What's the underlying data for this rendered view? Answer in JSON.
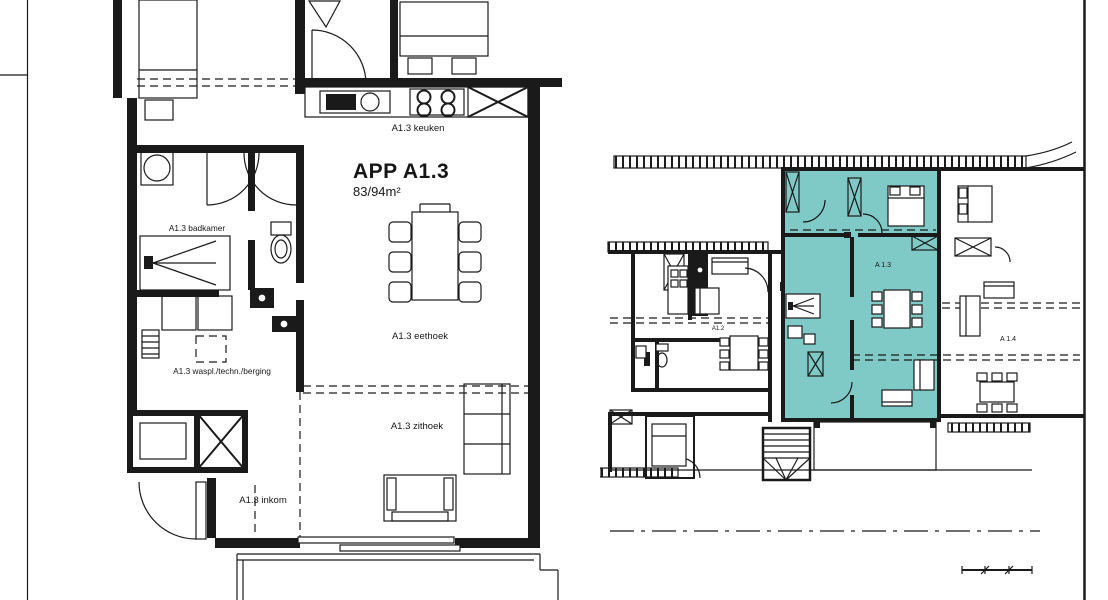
{
  "document": {
    "background_color": "#ffffff",
    "line_color": "#1a1a1a",
    "highlight_color": "#7fc9c6",
    "description": "Architectural floor plan: detail of apartment APP A1.3 (left) and floor overview with unit A1.3 highlighted (right)"
  },
  "detail_plan": {
    "title": "APP A1.3",
    "area": "83/94m²",
    "rooms": {
      "kitchen": "A1.3 keuken",
      "dining": "A1.3 eethoek",
      "living": "A1.3 zithoek",
      "bathroom": "A1.3 badkamer",
      "storage": "A1.3 waspl./techn./berging",
      "entrance": "A1.3 inkom"
    }
  },
  "overview_plan": {
    "highlighted_unit_label": "A 1.3",
    "left_unit_label": "A1.2",
    "right_unit_label": "A 1.4"
  }
}
